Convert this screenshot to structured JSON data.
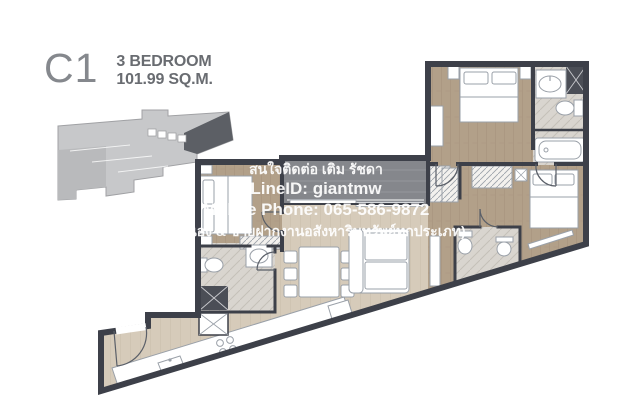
{
  "page": {
    "background_color": "#ffffff"
  },
  "header": {
    "unit_code": "C1",
    "unit_type": "3 BEDROOM",
    "unit_area": "101.99 SQ.M."
  },
  "watermark": {
    "lines": [
      "สนใจติดต่อ เติม รัชดา",
      "LineID: giantmw",
      "Mobile Phone: 065-586-9872",
      "(จำนอง & ขายฝากงานอสังหาริมทรัพย์ทุกประเภท)"
    ],
    "text_color": "#ffffff"
  },
  "floor_plan": {
    "colors": {
      "wall": "#3d4049",
      "wood_dark": "#b2a089",
      "wood_light": "#d6cbba",
      "tile": "#d9d5cf",
      "balcony": "#85878c",
      "shower_tile": "#4b4e56",
      "furniture_outline": "#9aa0a8",
      "key_plan_light": "#c7c8ca",
      "key_plan_dark": "#5c5f65",
      "title_color": "#85888d",
      "subtitle_color": "#696c71"
    }
  }
}
